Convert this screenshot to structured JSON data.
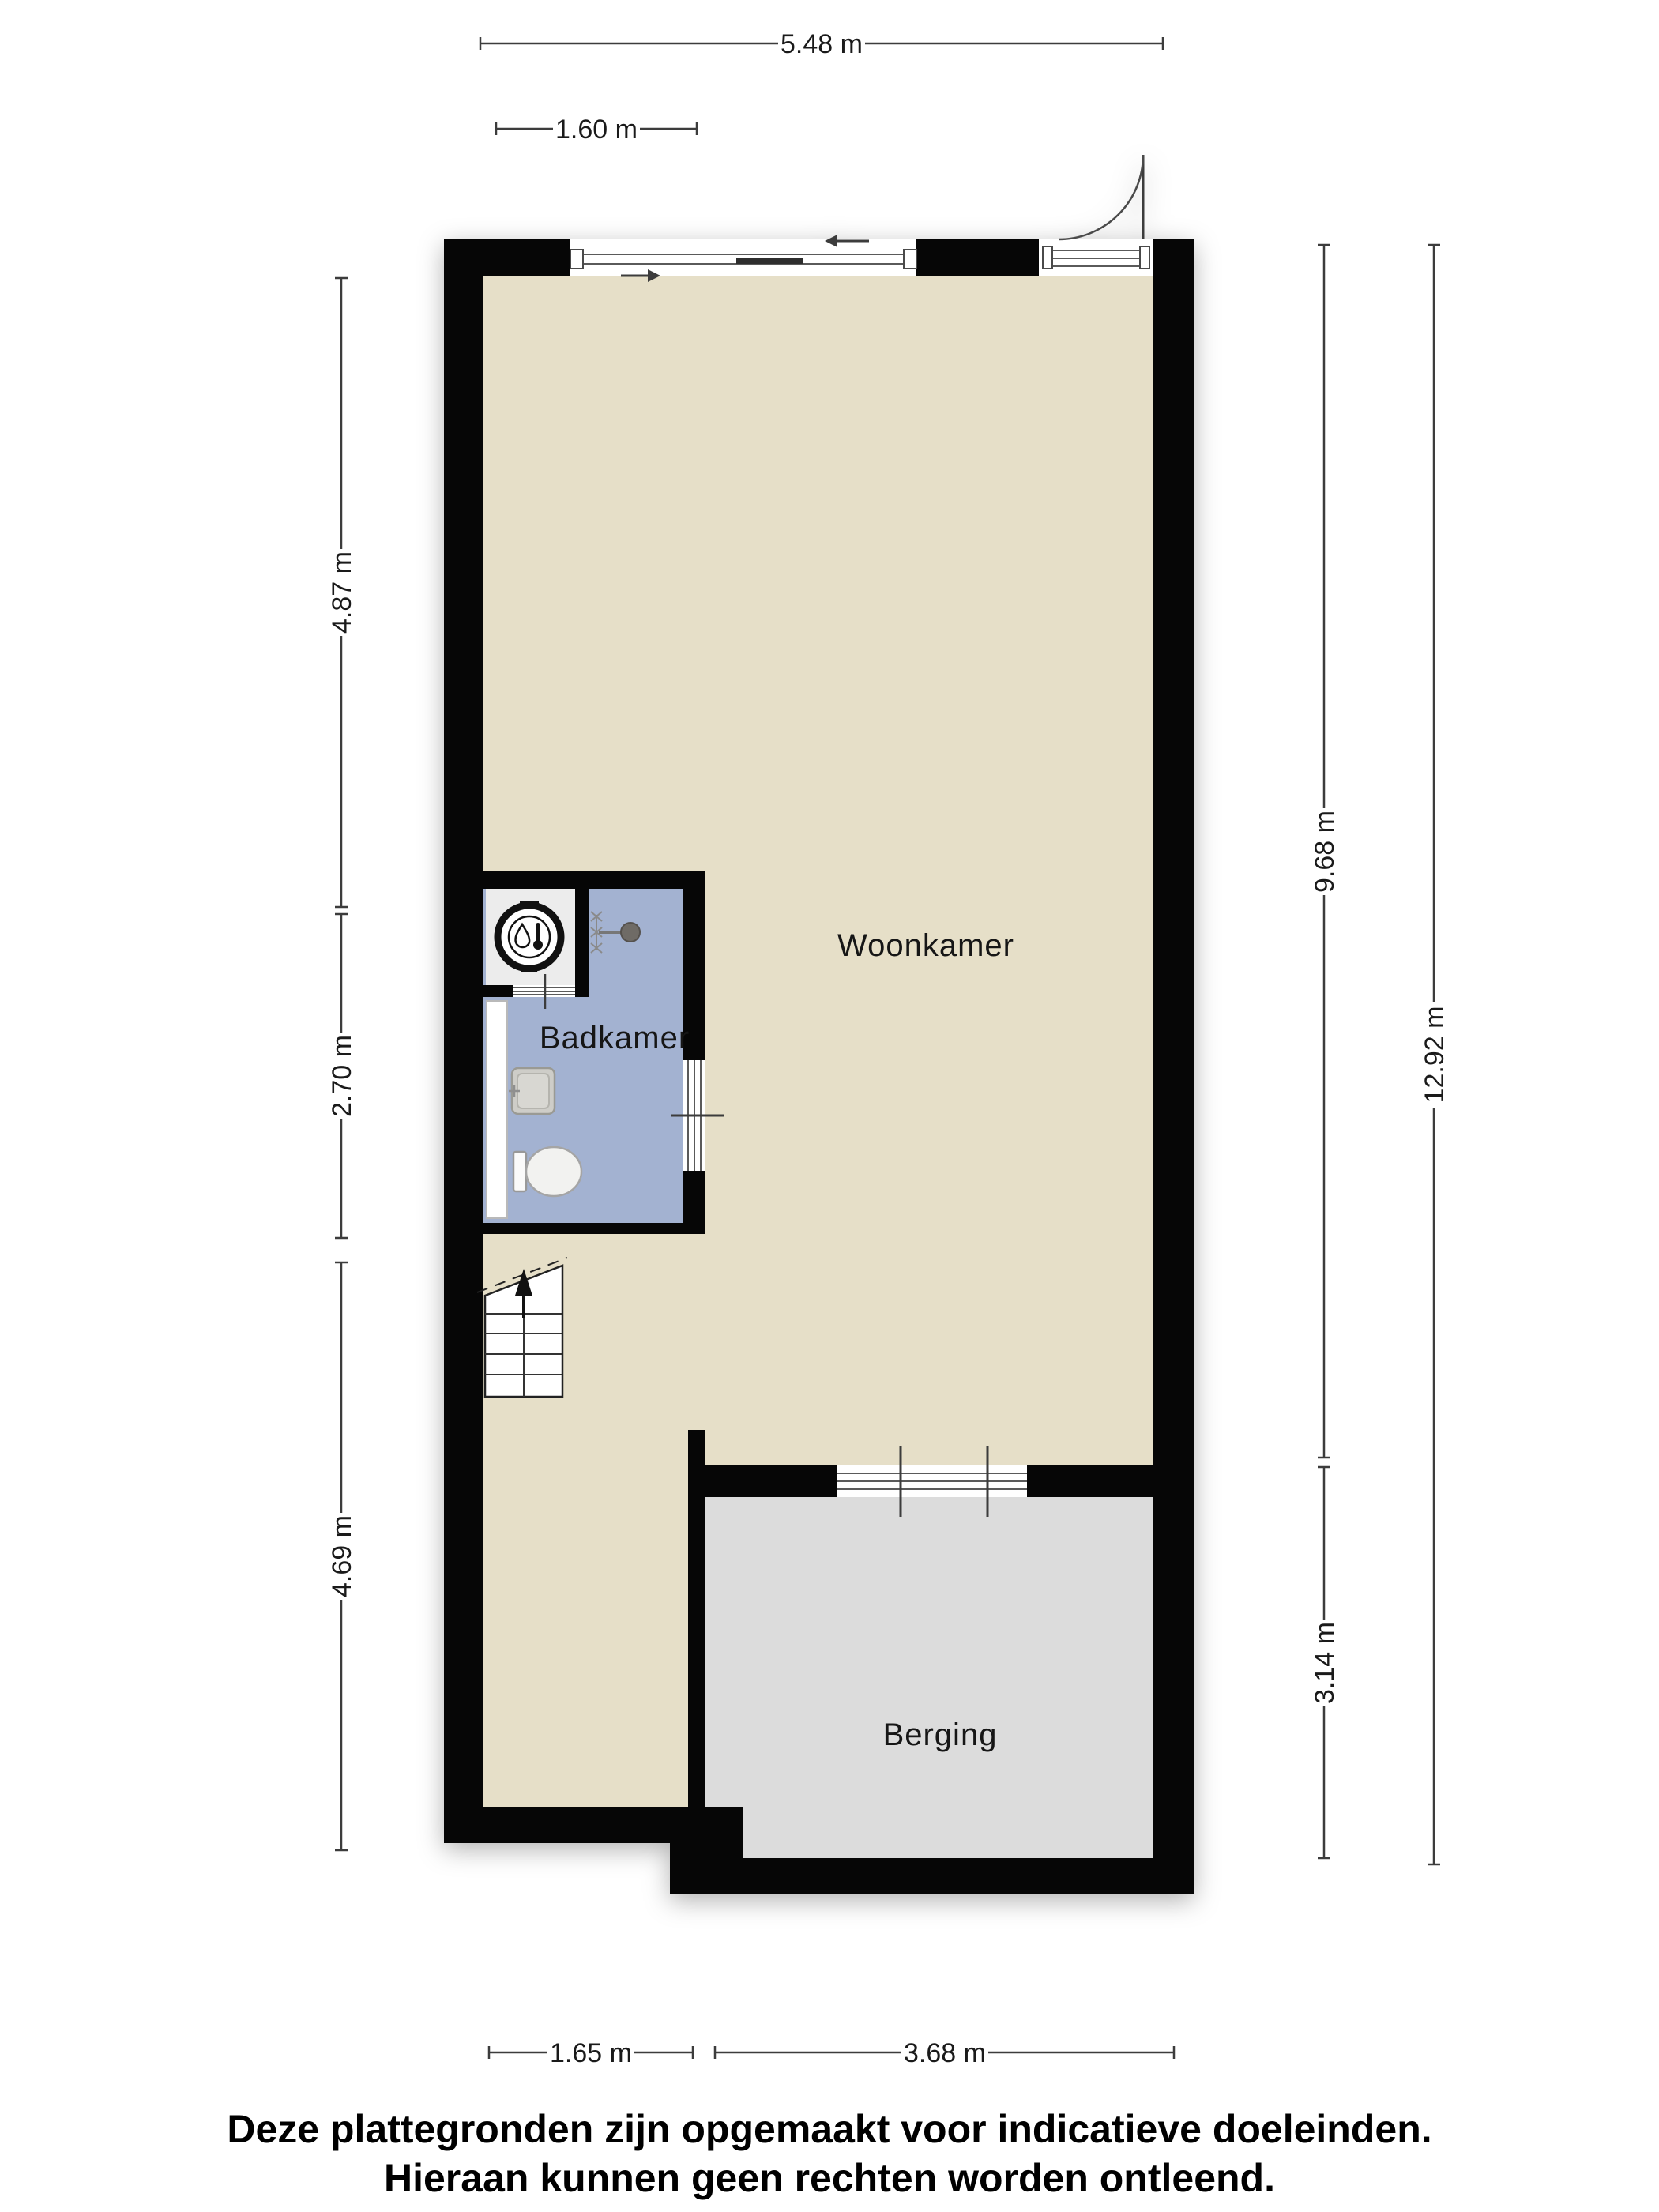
{
  "rooms": {
    "living": {
      "label": "Woonkamer"
    },
    "bathroom": {
      "label": "Badkamer"
    },
    "storage": {
      "label": "Berging"
    }
  },
  "dimensions": {
    "top_width": {
      "label": "5.48 m"
    },
    "top_window": {
      "label": "1.60 m"
    },
    "left_upper": {
      "label": "4.87 m"
    },
    "left_middle": {
      "label": "2.70 m"
    },
    "left_lower": {
      "label": "4.69 m"
    },
    "right_inner_upper": {
      "label": "9.68 m"
    },
    "right_outer": {
      "label": "12.92 m"
    },
    "right_inner_lower": {
      "label": "3.14 m"
    },
    "bottom_hall": {
      "label": "1.65 m"
    },
    "bottom_storage": {
      "label": "3.68 m"
    }
  },
  "disclaimer": {
    "line1": "Deze plattegronden zijn opgemaakt voor indicatieve doeleinden.",
    "line2": "Hieraan kunnen geen rechten worden ontleend."
  },
  "colors": {
    "floor_living": "#e6dfc8",
    "floor_bathroom": "#a3b2d1",
    "floor_storage": "#dcdcdc",
    "floor_closet": "#ececec",
    "wall": "#060606",
    "dimension_line": "#3c3c3c",
    "label_text": "#1a1a1a"
  },
  "icons": {
    "boiler": "boiler-icon",
    "shower": "shower-head-icon",
    "toilet": "toilet-icon",
    "sink": "sink-icon",
    "stairs_arrow": "stairs-up-arrow-icon",
    "entry_door": "door-swing-arc-icon",
    "slide_left": "slide-direction-left-arrow-icon",
    "slide_right": "slide-direction-right-arrow-icon"
  }
}
